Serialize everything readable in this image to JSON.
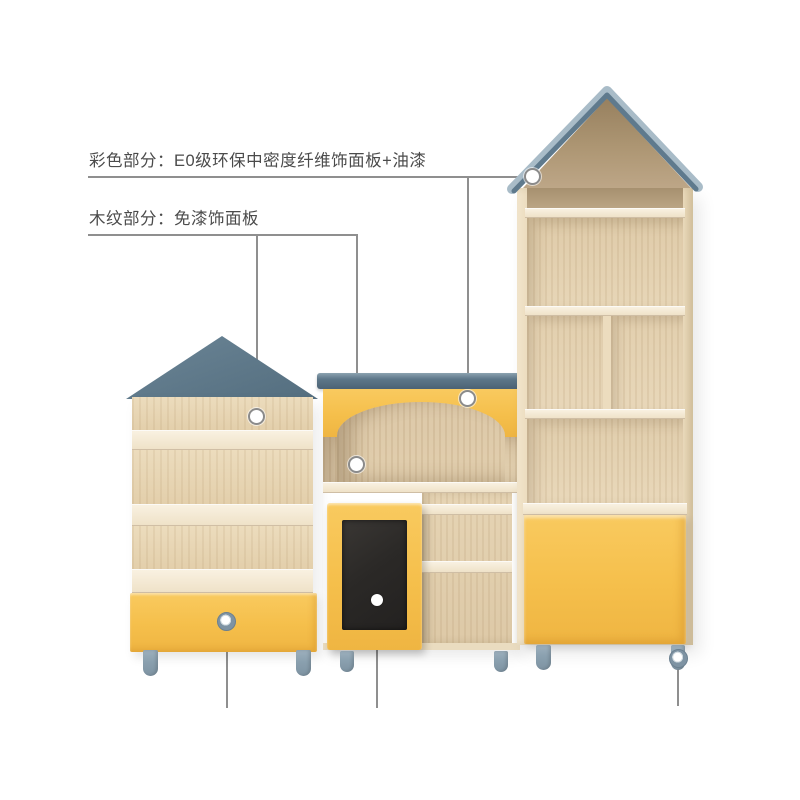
{
  "annotations": {
    "label_colored": "彩色部分：E0级环保中密度纤维饰面板+油漆",
    "label_woodgrain": "木纹部分：免漆饰面板",
    "callout_targets": {
      "colored": [
        "right-unit-roof-trim",
        "middle-unit-yellow-facade"
      ],
      "woodgrain": [
        "left-unit-wood-panel",
        "middle-unit-arch-panel"
      ],
      "bottom_unlabeled": [
        "left-drawer-knob",
        "chalkboard-door",
        "right-unit-leg"
      ]
    }
  },
  "colors": {
    "background": "#ffffff",
    "text": "#4b4b4b",
    "callout_line": "#8f8f8f",
    "accent_yellow": "#f5bf4b",
    "roof_slate": "#5e7889",
    "roof_slate_dark": "#4d6375",
    "roof_trim_light": "#a3b6c2",
    "wood_light": "#ecdcbe",
    "wood_mid": "#e3cfab",
    "gable_wood": "#b19a79",
    "chalkboard": "#2b2927",
    "leg_gray": "#8aa0af"
  }
}
